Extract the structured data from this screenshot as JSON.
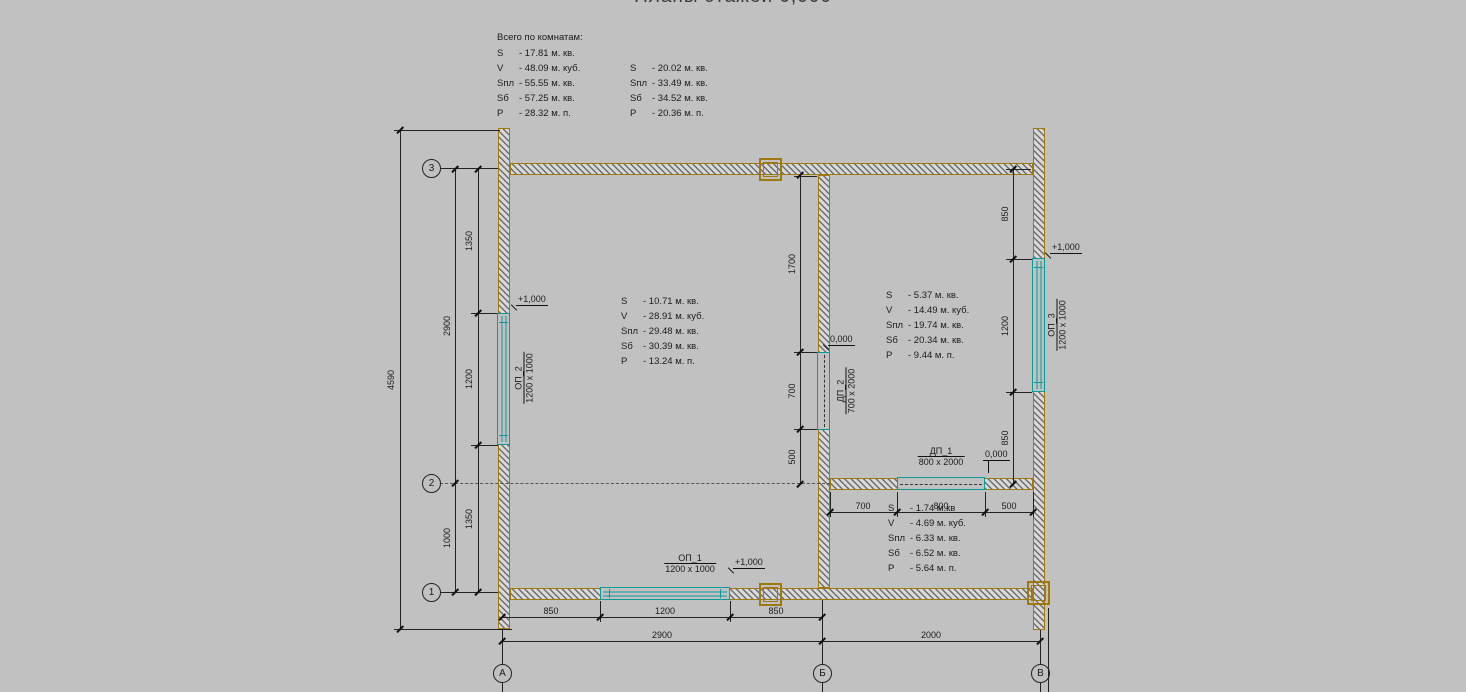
{
  "title": "Планы этажей 0,000",
  "summary": {
    "heading": "Всего по комнатам:",
    "left": [
      [
        "S",
        "-  17.81 м. кв."
      ],
      [
        "V",
        "-  48.09 м. куб."
      ],
      [
        "Sпл",
        "-  55.55 м. кв."
      ],
      [
        "Sб",
        "-  57.25 м. кв."
      ],
      [
        "P",
        "-  28.32 м. п."
      ]
    ],
    "right": [
      [
        "S",
        "-  20.02 м. кв."
      ],
      [
        "Sпл",
        "-  33.49 м. кв."
      ],
      [
        "Sб",
        "-  34.52 м. кв."
      ],
      [
        "P",
        "-  20.36 м. п."
      ]
    ]
  },
  "rooms": [
    {
      "lines": [
        [
          "S",
          "-  10.71 м. кв."
        ],
        [
          "V",
          "-  28.91 м. куб."
        ],
        [
          "Sпл",
          "-  29.48 м. кв."
        ],
        [
          "Sб",
          "-  30.39 м. кв."
        ],
        [
          "P",
          "-  13.24 м. п."
        ]
      ]
    },
    {
      "lines": [
        [
          "S",
          "-  5.37 м. кв."
        ],
        [
          "V",
          "-  14.49 м. куб."
        ],
        [
          "Sпл",
          "-  19.74 м. кв."
        ],
        [
          "Sб",
          "-  20.34 м. кв."
        ],
        [
          "P",
          "-  9.44 м. п."
        ]
      ]
    },
    {
      "lines": [
        [
          "S",
          "-  1.74 м.кв"
        ],
        [
          "V",
          "-  4.69 м. куб."
        ],
        [
          "Sпл",
          "-  6.33 м. кв."
        ],
        [
          "Sб",
          "-  6.52 м. кв."
        ],
        [
          "P",
          "-  5.64 м. п."
        ]
      ]
    }
  ],
  "openings": [
    {
      "name": "ОП_1",
      "size": "1200 x 1000"
    },
    {
      "name": "ОП_2",
      "size": "1200 x 1000"
    },
    {
      "name": "ОП_3",
      "size": "1200 x 1000"
    },
    {
      "name": "ДП_1",
      "size": "800 x 2000"
    },
    {
      "name": "ДП_2",
      "size": "700 x 2000"
    }
  ],
  "levels": {
    "plus": "+1,000",
    "zero": "0,000"
  },
  "axes": {
    "rows": [
      "3",
      "2",
      "1"
    ],
    "cols": [
      "А",
      "Б",
      "В"
    ]
  },
  "dims": {
    "total_height": "4590",
    "left_mid": [
      "2900",
      "1000"
    ],
    "left_inner": [
      "1350",
      "1200",
      "1350"
    ],
    "right_inner": [
      "850",
      "1200",
      "850"
    ],
    "mid_inner": [
      "1700",
      "700",
      "500"
    ],
    "room3_inner": [
      "700",
      "800",
      "500"
    ],
    "bottom_inner": [
      "850",
      "1200",
      "850"
    ],
    "bottom_axes": [
      "2900",
      "2000"
    ]
  },
  "colors": {
    "background": "#c1c1c1",
    "wall_outline": "#a0790e",
    "opening": "#0a9a9a",
    "line": "#222222"
  }
}
